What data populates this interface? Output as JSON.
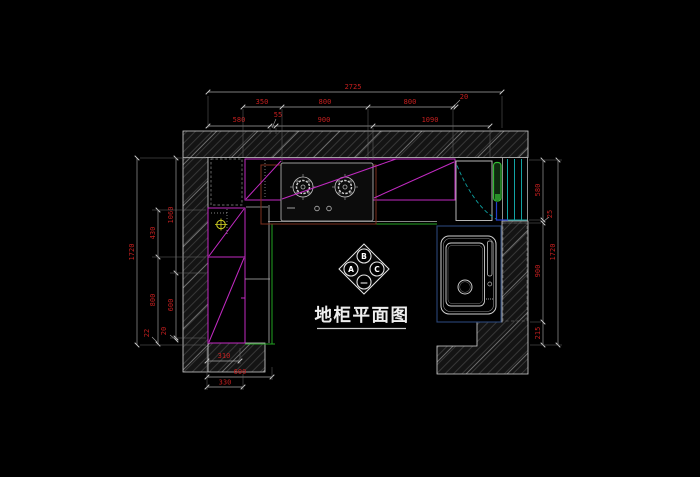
{
  "title": {
    "text": "地柜平面图"
  },
  "index_symbol": {
    "top": "B",
    "left": "A",
    "right": "C",
    "bottom": "—"
  },
  "dims": {
    "top_overall": "2725",
    "top_row2": [
      "350",
      "800",
      "800",
      "20"
    ],
    "top_row3": [
      "580",
      "55",
      "900",
      "1090"
    ],
    "left_overall": "1720",
    "left_outer": [
      "430",
      "800",
      "22"
    ],
    "left_inner": [
      "1060",
      "600",
      "20"
    ],
    "right_overall": "1720",
    "right_chain": [
      "580",
      "25",
      "900",
      "215"
    ],
    "bottom": [
      "310",
      "600",
      "330"
    ]
  },
  "colors": {
    "background": "#000000",
    "dimension_text": "#c61f1f",
    "cabinet_magenta": "#c22ac2",
    "counter_green": "#22a322",
    "window_cyan": "#12a4a4",
    "door_green": "#33bb33",
    "door_blue": "#2440cc",
    "sink_border": "#2a4679",
    "stove_border": "#7d2f1e",
    "gas_symbol": "#cfcf22",
    "wall_outline": "#d5d5d5"
  }
}
